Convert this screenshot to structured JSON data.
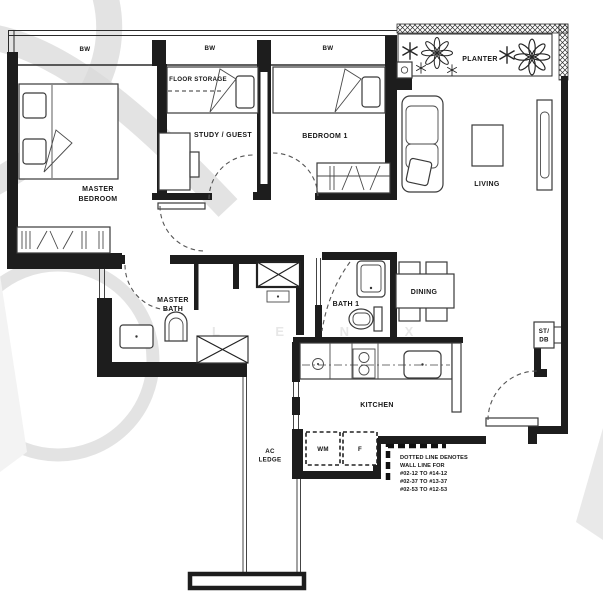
{
  "plan": {
    "bay_window_label": "BW",
    "planter": "PLANTER",
    "floor_storage": "FLOOR STORAGE",
    "study_guest": "STUDY / GUEST",
    "bedroom1": "BEDROOM 1",
    "master_bedroom_line1": "MASTER",
    "master_bedroom_line2": "BEDROOM",
    "living": "LIVING",
    "dining": "DINING",
    "kitchen": "KITCHEN",
    "master_bath_line1": "MASTER",
    "master_bath_line2": "BATH",
    "bath1": "BATH 1",
    "ac_ledge_line1": "AC",
    "ac_ledge_line2": "LEDGE",
    "wm": "WM",
    "fridge": "F",
    "st_db_line1": "ST/",
    "st_db_line2": "DB",
    "note_line1": "DOTTED LINE DENOTES",
    "note_line2": "WALL LINE FOR",
    "note_line3": "#02-12 TO #14-12",
    "note_line4": "#02-37 TO #13-37",
    "note_line5": "#02-53 TO #12-53",
    "watermark_letters": "L E N X"
  },
  "colors": {
    "line": "#1d1d1d",
    "watermark": "#dadada",
    "background": "#ffffff"
  }
}
